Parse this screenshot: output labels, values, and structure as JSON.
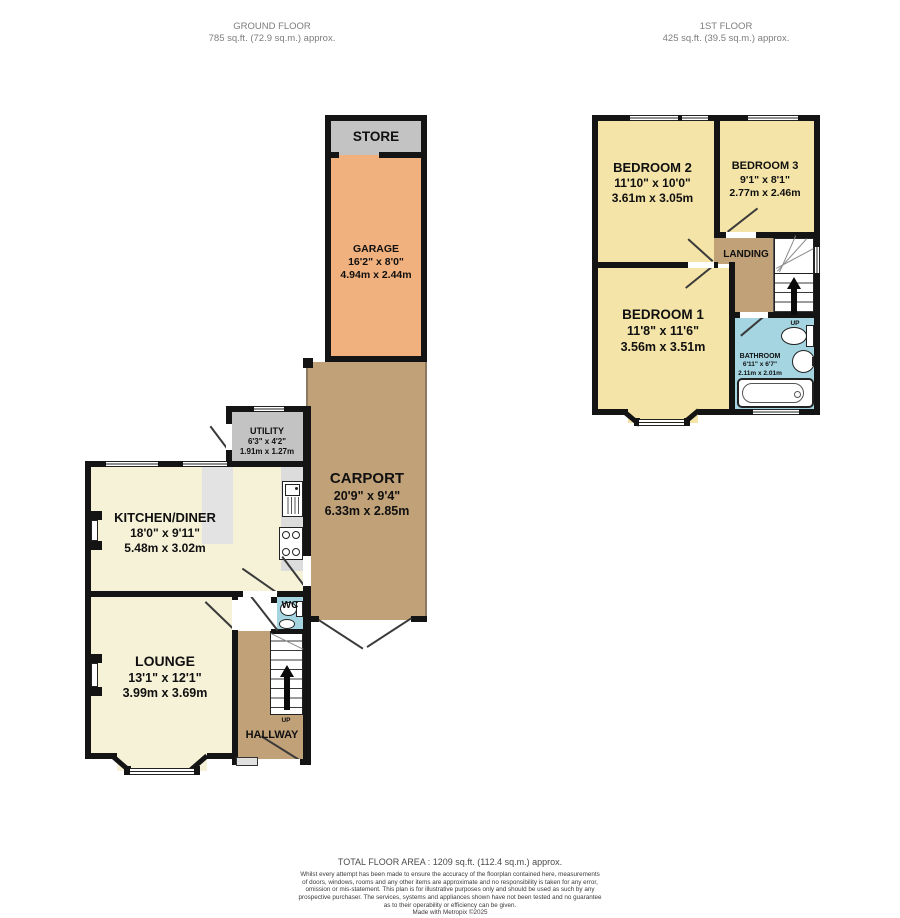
{
  "header": {
    "ground_floor": {
      "title": "GROUND FLOOR",
      "area": "785 sq.ft. (72.9 sq.m.) approx."
    },
    "first_floor": {
      "title": "1ST FLOOR",
      "area": "425 sq.ft. (39.5 sq.m.) approx."
    }
  },
  "rooms": {
    "store": {
      "name": "STORE"
    },
    "garage": {
      "name": "GARAGE",
      "dim_ft": "16'2\" x 8'0\"",
      "dim_m": "4.94m x 2.44m"
    },
    "carport": {
      "name": "CARPORT",
      "dim_ft": "20'9\" x 9'4\"",
      "dim_m": "6.33m x 2.85m"
    },
    "utility": {
      "name": "UTILITY",
      "dim_ft": "6'3\" x 4'2\"",
      "dim_m": "1.91m x 1.27m"
    },
    "kitchen": {
      "name": "KITCHEN/DINER",
      "dim_ft": "18'0\" x 9'11\"",
      "dim_m": "5.48m x 3.02m"
    },
    "lounge": {
      "name": "LOUNGE",
      "dim_ft": "13'1\" x 12'1\"",
      "dim_m": "3.99m x 3.69m"
    },
    "wc": {
      "name": "WC"
    },
    "hallway": {
      "name": "HALLWAY"
    },
    "bedroom2": {
      "name": "BEDROOM 2",
      "dim_ft": "11'10\" x 10'0\"",
      "dim_m": "3.61m x 3.05m"
    },
    "bedroom3": {
      "name": "BEDROOM 3",
      "dim_ft": "9'1\" x 8'1\"",
      "dim_m": "2.77m x 2.46m"
    },
    "bedroom1": {
      "name": "BEDROOM 1",
      "dim_ft": "11'8\" x 11'6\"",
      "dim_m": "3.56m x 3.51m"
    },
    "landing": {
      "name": "LANDING"
    },
    "bathroom": {
      "name": "BATHROOM",
      "dim_ft": "6'11\" x 6'7\"",
      "dim_m": "2.11m x 2.01m"
    }
  },
  "stairs": {
    "up_label": "UP"
  },
  "icons": {
    "toilet": "oval bowl with cistern",
    "basin": "round wash basin",
    "bathtub": "rounded rectangle tub",
    "sink": "sink with drainer",
    "stove": "4-burner hob",
    "up_arrow": "black stair direction arrow"
  },
  "colors": {
    "wall": "#141414",
    "store_utility": "#c3c3c3",
    "garage": "#f1b17e",
    "carport_hall_landing": "#c1a177",
    "living_cream": "#f6f2d8",
    "bedroom_yellow": "#f4e4a7",
    "wet_room_blue": "#a5d5e1"
  },
  "footer": {
    "total_area": "TOTAL FLOOR AREA : 1209 sq.ft. (112.4 sq.m.) approx.",
    "disclaimer_lines": [
      "Whilst every attempt has been made to ensure the accuracy of the floorplan contained here, measurements",
      "of doors, windows, rooms and any other items are approximate and no responsibility is taken for any error,",
      "omission or mis-statement. This plan is for illustrative purposes only and should be used as such by any",
      "prospective purchaser. The services, systems and appliances shown have not been tested and no guarantee",
      "as to their operability or efficiency can be given."
    ],
    "credit": "Made with Metropix ©2025"
  }
}
